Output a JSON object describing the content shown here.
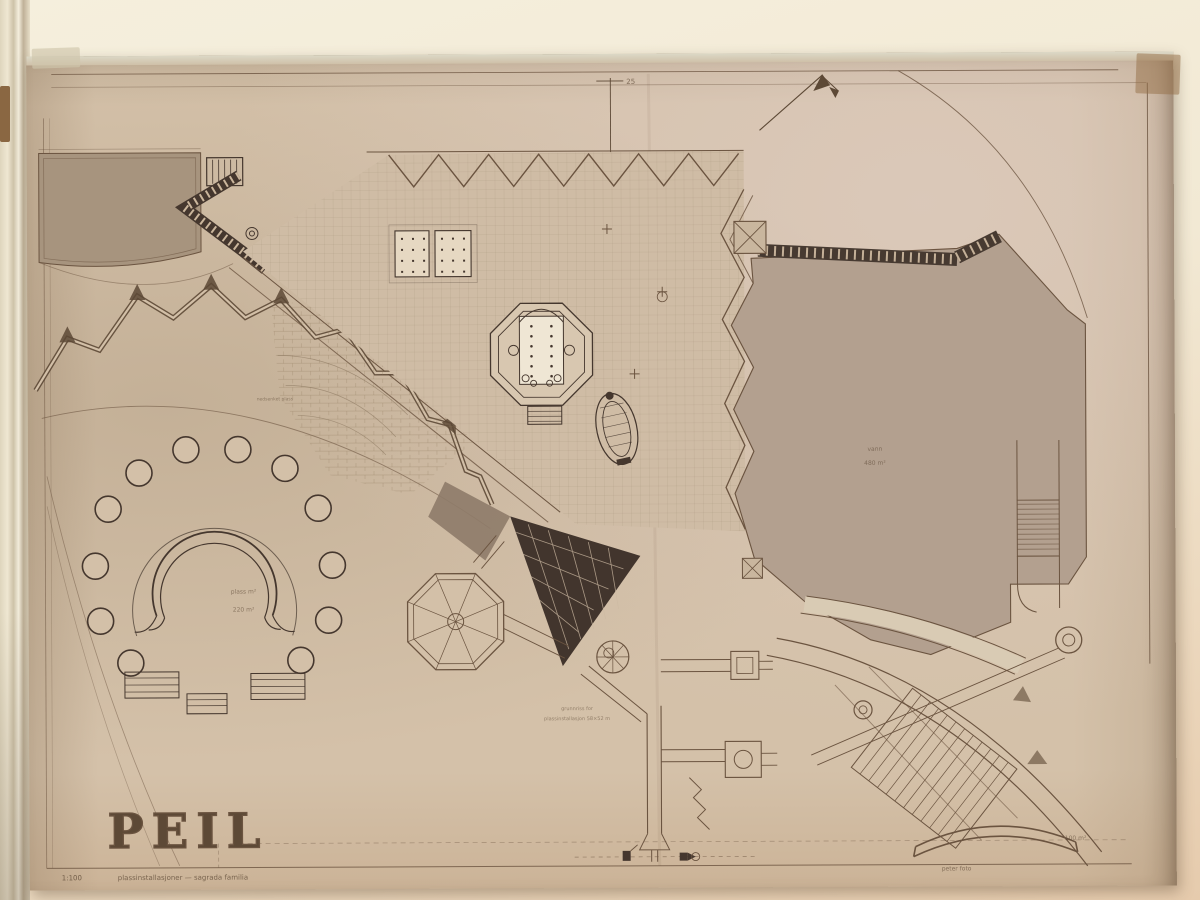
{
  "colors": {
    "wall": "#f2e9d4",
    "paper": "#d4c1a9",
    "ink": "#6b5440",
    "dark_fill": "#45372e",
    "east_plaza_fill": "#b3a08f"
  },
  "sheet": {
    "stamp": "PEIL",
    "top": {
      "dim_label": "25"
    },
    "areas": {
      "left_court": {
        "line1": "plass m²",
        "line2": "220 m²"
      },
      "east_plaza": {
        "line1": "vann",
        "line2": "480 m²"
      },
      "south_east": "100 m²"
    },
    "notes": {
      "mosaic_path": "mosaikk gangvei",
      "sunken_court": "nedsenket plass",
      "detail_line1": "grunnriss for",
      "detail_line2": "plassinstallasjon 58×52 m"
    },
    "footer": {
      "scale": "1:100",
      "caption": "plassinstallasjoner — sagrada familia",
      "credit": "peter foto"
    }
  }
}
